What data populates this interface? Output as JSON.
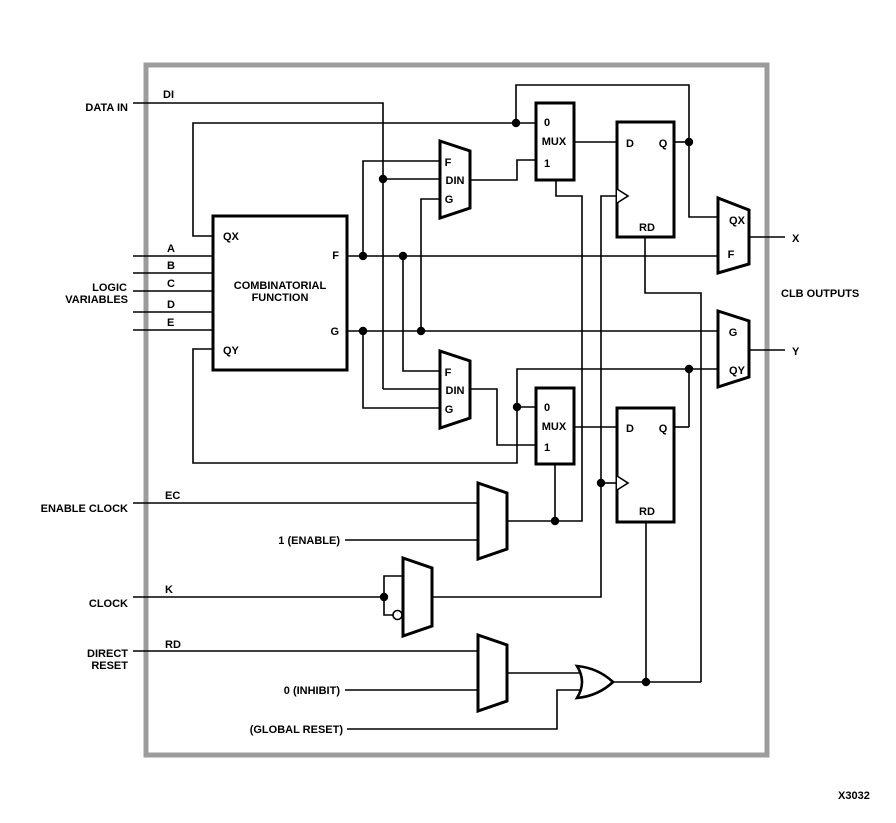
{
  "figure_label": "X3032",
  "colors": {
    "line": "#000000",
    "frame": "#9c9c9c",
    "background": "#ffffff"
  },
  "frame": {
    "x": 146,
    "y": 65,
    "w": 621,
    "h": 690
  },
  "texts": [
    {
      "name": "label-data-in",
      "text": "DATA IN",
      "x": 128,
      "y": 111,
      "anchor": "end"
    },
    {
      "name": "label-di",
      "text": "DI",
      "x": 163,
      "y": 98,
      "anchor": "start"
    },
    {
      "name": "label-logic",
      "text": "LOGIC",
      "x": 127,
      "y": 291,
      "anchor": "end"
    },
    {
      "name": "label-variables",
      "text": "VARIABLES",
      "x": 128,
      "y": 303,
      "anchor": "end"
    },
    {
      "name": "label-input-a",
      "text": "A",
      "x": 167,
      "y": 252,
      "anchor": "start"
    },
    {
      "name": "label-input-b",
      "text": "B",
      "x": 167,
      "y": 269,
      "anchor": "start"
    },
    {
      "name": "label-input-c",
      "text": "C",
      "x": 167,
      "y": 287,
      "anchor": "start"
    },
    {
      "name": "label-input-d",
      "text": "D",
      "x": 167,
      "y": 308,
      "anchor": "start"
    },
    {
      "name": "label-input-e",
      "text": "E",
      "x": 167,
      "y": 326,
      "anchor": "start"
    },
    {
      "name": "label-enable-clock",
      "text": "ENABLE CLOCK",
      "x": 128,
      "y": 512,
      "anchor": "end"
    },
    {
      "name": "label-ec",
      "text": "EC",
      "x": 165,
      "y": 499,
      "anchor": "start"
    },
    {
      "name": "label-clock",
      "text": "CLOCK",
      "x": 128,
      "y": 607,
      "anchor": "end"
    },
    {
      "name": "label-k",
      "text": "K",
      "x": 165,
      "y": 593,
      "anchor": "start"
    },
    {
      "name": "label-direct",
      "text": "DIRECT",
      "x": 128,
      "y": 657,
      "anchor": "end"
    },
    {
      "name": "label-reset",
      "text": "RESET",
      "x": 128,
      "y": 669,
      "anchor": "end"
    },
    {
      "name": "label-rd",
      "text": "RD",
      "x": 165,
      "y": 648,
      "anchor": "start"
    },
    {
      "name": "label-one-enable",
      "text": "1 (ENABLE)",
      "x": 340,
      "y": 544,
      "anchor": "end"
    },
    {
      "name": "label-zero-inhibit",
      "text": "0 (INHIBIT)",
      "x": 340,
      "y": 694,
      "anchor": "end"
    },
    {
      "name": "label-global-reset",
      "text": "(GLOBAL RESET)",
      "x": 343,
      "y": 733,
      "anchor": "end"
    },
    {
      "name": "label-x-output",
      "text": "X",
      "x": 792,
      "y": 242,
      "anchor": "start"
    },
    {
      "name": "label-y-output",
      "text": "Y",
      "x": 792,
      "y": 355,
      "anchor": "start"
    },
    {
      "name": "label-clb-outputs",
      "text": "CLB OUTPUTS",
      "x": 781,
      "y": 297,
      "anchor": "start"
    },
    {
      "name": "label-figure-id",
      "text": "X3032",
      "x": 838,
      "y": 799,
      "anchor": "start"
    },
    {
      "name": "label-cf-qx",
      "text": "QX",
      "x": 223,
      "y": 240,
      "anchor": "start"
    },
    {
      "name": "label-cf-f",
      "text": "F",
      "x": 339,
      "y": 259,
      "anchor": "end"
    },
    {
      "name": "label-cf-g",
      "text": "G",
      "x": 339,
      "y": 335,
      "anchor": "end"
    },
    {
      "name": "label-cf-line1",
      "text": "COMBINATORIAL",
      "x": 280,
      "y": 289,
      "anchor": "middle"
    },
    {
      "name": "label-cf-line2",
      "text": "FUNCTION",
      "x": 280,
      "y": 301,
      "anchor": "middle"
    },
    {
      "name": "label-cf-qy",
      "text": "QY",
      "x": 223,
      "y": 354,
      "anchor": "start"
    },
    {
      "name": "label-mux1-0",
      "text": "0",
      "x": 547,
      "y": 126,
      "anchor": "middle"
    },
    {
      "name": "label-mux1-mux",
      "text": "MUX",
      "x": 554,
      "y": 145,
      "anchor": "middle"
    },
    {
      "name": "label-mux1-1",
      "text": "1",
      "x": 547,
      "y": 167,
      "anchor": "middle"
    },
    {
      "name": "label-ff1-d",
      "text": "D",
      "x": 630,
      "y": 147,
      "anchor": "middle"
    },
    {
      "name": "label-ff1-q",
      "text": "Q",
      "x": 663,
      "y": 147,
      "anchor": "middle"
    },
    {
      "name": "label-ff1-rd",
      "text": "RD",
      "x": 647,
      "y": 231,
      "anchor": "middle"
    },
    {
      "name": "label-dinmux1-f",
      "text": "F",
      "x": 448,
      "y": 166,
      "anchor": "middle"
    },
    {
      "name": "label-dinmux1-din",
      "text": "DIN",
      "x": 455,
      "y": 184,
      "anchor": "middle"
    },
    {
      "name": "label-dinmux1-g",
      "text": "G",
      "x": 449,
      "y": 203,
      "anchor": "middle"
    },
    {
      "name": "label-dinmux2-f",
      "text": "F",
      "x": 448,
      "y": 376,
      "anchor": "middle"
    },
    {
      "name": "label-dinmux2-din",
      "text": "DIN",
      "x": 455,
      "y": 394,
      "anchor": "middle"
    },
    {
      "name": "label-dinmux2-g",
      "text": "G",
      "x": 449,
      "y": 413,
      "anchor": "middle"
    },
    {
      "name": "label-mux2-0",
      "text": "0",
      "x": 547,
      "y": 411,
      "anchor": "middle"
    },
    {
      "name": "label-mux2-mux",
      "text": "MUX",
      "x": 554,
      "y": 430,
      "anchor": "middle"
    },
    {
      "name": "label-mux2-1",
      "text": "1",
      "x": 547,
      "y": 451,
      "anchor": "middle"
    },
    {
      "name": "label-ff2-d",
      "text": "D",
      "x": 630,
      "y": 432,
      "anchor": "middle"
    },
    {
      "name": "label-ff2-q",
      "text": "Q",
      "x": 663,
      "y": 432,
      "anchor": "middle"
    },
    {
      "name": "label-ff2-rd",
      "text": "RD",
      "x": 647,
      "y": 515,
      "anchor": "middle"
    },
    {
      "name": "label-xmux-qx",
      "text": "QX",
      "x": 737,
      "y": 224,
      "anchor": "middle"
    },
    {
      "name": "label-xmux-f",
      "text": "F",
      "x": 731,
      "y": 258,
      "anchor": "middle"
    },
    {
      "name": "label-ymux-g",
      "text": "G",
      "x": 733,
      "y": 336,
      "anchor": "middle"
    },
    {
      "name": "label-ymux-qy",
      "text": "QY",
      "x": 737,
      "y": 374,
      "anchor": "middle"
    }
  ],
  "wires": [
    {
      "name": "wire-di",
      "d": "M133,103 H383 V389"
    },
    {
      "name": "wire-din1-in",
      "d": "M383,179 H440"
    },
    {
      "name": "wire-din2-in",
      "d": "M383,389 H440"
    },
    {
      "name": "wire-input-a",
      "d": "M133,256 H213"
    },
    {
      "name": "wire-input-b",
      "d": "M133,273 H213"
    },
    {
      "name": "wire-input-c",
      "d": "M133,291 H213"
    },
    {
      "name": "wire-input-d",
      "d": "M133,312 H213"
    },
    {
      "name": "wire-input-e",
      "d": "M133,330 H213"
    },
    {
      "name": "wire-qx-feedback",
      "d": "M536,123 H193 V236 H213"
    },
    {
      "name": "wire-q1-loop",
      "d": "M516,123 V85 H689 V217 H718"
    },
    {
      "name": "wire-q1-out",
      "d": "M674,142 H689"
    },
    {
      "name": "wire-f",
      "d": "M347,256 H718"
    },
    {
      "name": "wire-f-to-dinmux1",
      "d": "M363,256 V161 H440"
    },
    {
      "name": "wire-f-to-dinmux2",
      "d": "M403,256 V371 H440"
    },
    {
      "name": "wire-g",
      "d": "M347,331 H718"
    },
    {
      "name": "wire-g-to-dinmux1",
      "d": "M421,331 V199 H440"
    },
    {
      "name": "wire-g-to-dinmux2",
      "d": "M363,331 V408 H440"
    },
    {
      "name": "wire-dinmux1-out",
      "d": "M470,180 H517 V160 H536"
    },
    {
      "name": "wire-dinmux2-out",
      "d": "M470,389 H497 V445 H536"
    },
    {
      "name": "wire-mux1-out",
      "d": "M574,142 H617"
    },
    {
      "name": "wire-mux2-out",
      "d": "M574,427 H617"
    },
    {
      "name": "wire-q2-out",
      "d": "M674,427 H689"
    },
    {
      "name": "wire-qy-to-outmux",
      "d": "M689,427 V369 H718"
    },
    {
      "name": "wire-qy-feedback",
      "d": "M689,369 H517 V463 H193 V349 H213"
    },
    {
      "name": "wire-mux2-0-in",
      "d": "M517,407 H536"
    },
    {
      "name": "wire-ec",
      "d": "M133,503 H478"
    },
    {
      "name": "wire-enable-1",
      "d": "M345,540 H478"
    },
    {
      "name": "wire-ecmux-out",
      "d": "M507,521 H582 V196 H556 V180"
    },
    {
      "name": "wire-mux2-select",
      "d": "M555,521 V464"
    },
    {
      "name": "wire-k",
      "d": "M133,597 H384"
    },
    {
      "name": "wire-k-direct",
      "d": "M384,597 V576 H403"
    },
    {
      "name": "wire-k-inverted",
      "d": "M384,597 V615 H393"
    },
    {
      "name": "wire-clock-out",
      "d": "M432,597 H601 V196 H617"
    },
    {
      "name": "wire-clock-ff2",
      "d": "M601,483 H617"
    },
    {
      "name": "wire-rd",
      "d": "M133,651 H478"
    },
    {
      "name": "wire-inhibit-0",
      "d": "M345,690 H478"
    },
    {
      "name": "wire-rdmux-out",
      "d": "M507,673 H584"
    },
    {
      "name": "wire-global-reset",
      "d": "M347,729 H557 V690 H584"
    },
    {
      "name": "wire-or-out",
      "d": "M613,682 H701"
    },
    {
      "name": "wire-reset-ff2",
      "d": "M646,682 V523"
    },
    {
      "name": "wire-reset-ff1",
      "d": "M701,682 V293 H645 V237"
    },
    {
      "name": "wire-x-out",
      "d": "M749,237 H785"
    },
    {
      "name": "wire-y-out",
      "d": "M749,350 H785"
    }
  ],
  "blocks": [
    {
      "name": "combinatorial-function-box",
      "x": 213,
      "y": 216,
      "w": 134,
      "h": 154
    },
    {
      "name": "mux1-box",
      "x": 536,
      "y": 103,
      "w": 38,
      "h": 77
    },
    {
      "name": "ff1-box",
      "x": 617,
      "y": 122,
      "w": 57,
      "h": 115
    },
    {
      "name": "mux2-box",
      "x": 536,
      "y": 388,
      "w": 38,
      "h": 76
    },
    {
      "name": "ff2-box",
      "x": 617,
      "y": 408,
      "w": 57,
      "h": 114
    }
  ],
  "trapezoids": [
    {
      "name": "din-mux-top",
      "points": "440,141 470,151 470,208 440,218"
    },
    {
      "name": "din-mux-bottom",
      "points": "440,351 470,361 470,418 440,428"
    },
    {
      "name": "enable-clock-mux",
      "points": "478,483 507,493 507,549 478,559"
    },
    {
      "name": "clock-polarity-mux",
      "points": "403,558 432,568 432,626 403,636"
    },
    {
      "name": "reset-mux",
      "points": "478,635 507,645 507,701 478,711"
    },
    {
      "name": "x-output-mux",
      "points": "718,198 749,210 749,264 718,273"
    },
    {
      "name": "y-output-mux",
      "points": "718,311 749,321 749,377 718,387"
    }
  ],
  "or_gate": {
    "name": "reset-or-gate",
    "d": "M577,666 Q598,668 613,682 Q598,696 577,698 Q587,682 577,666 Z"
  },
  "inverter_bubble": {
    "name": "clock-invert-bubble",
    "cx": 397.5,
    "cy": 615,
    "r": 4.5
  },
  "clock_marks": [
    {
      "name": "ff1-clock-triangle",
      "d": "M617,189 L628,196 L617,203"
    },
    {
      "name": "ff2-clock-triangle",
      "d": "M617,476 L628,483 L617,490"
    }
  ],
  "junction_dots": [
    [
      516,
      123
    ],
    [
      689,
      142
    ],
    [
      383,
      179
    ],
    [
      363,
      256
    ],
    [
      403,
      256
    ],
    [
      363,
      331
    ],
    [
      421,
      331
    ],
    [
      689,
      369
    ],
    [
      517,
      407
    ],
    [
      601,
      483
    ],
    [
      555,
      521
    ],
    [
      384,
      597
    ],
    [
      646,
      682
    ]
  ]
}
